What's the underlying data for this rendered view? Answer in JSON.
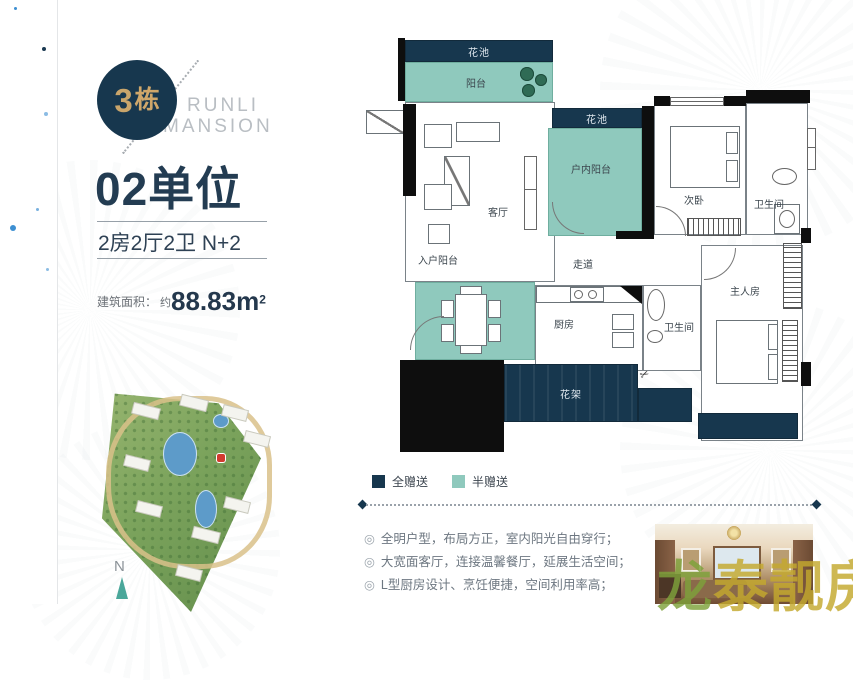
{
  "brand": {
    "building_badge_num": "3",
    "building_badge_char": "栋",
    "name_line1": "RUNLI",
    "name_line2": "MANSION"
  },
  "unit": {
    "title": "02单位",
    "layout": "2房2厅2卫 N+2",
    "area_label": "建筑面积：",
    "area_prefix": "约",
    "area_value": "88.83m",
    "area_exponent": "2"
  },
  "compass_label": "N",
  "floorplan": {
    "rooms": {
      "flower_bed_top": "花池",
      "balcony": "阳台",
      "living_room": "客厅",
      "flower_bed_right": "花池",
      "indoor_balcony": "户内阳台",
      "second_bedroom": "次卧",
      "bathroom_top": "卫生间",
      "corridor": "走道",
      "entry_balcony": "入户阳台",
      "kitchen": "厨房",
      "bathroom_mid": "卫生间",
      "master_bedroom": "主人房",
      "flower_rack": "花架"
    },
    "legend": [
      {
        "label": "全赠送",
        "color": "#17374e"
      },
      {
        "label": "半赠送",
        "color": "#8fc9bd"
      }
    ]
  },
  "feature_bullet": "◎",
  "features": [
    "全明户型，布局方正，室内阳光自由穿行；",
    "大宽面客厅，连接温馨餐厅，延展生活空间；",
    "L型厨房设计、烹饪便捷，空间利用率高；"
  ],
  "watermark_char1": "龙",
  "watermark_rest": "泰靓房",
  "colors": {
    "navy": "#17374e",
    "teal": "#8fc9bd",
    "gold": "#c9a56b"
  }
}
